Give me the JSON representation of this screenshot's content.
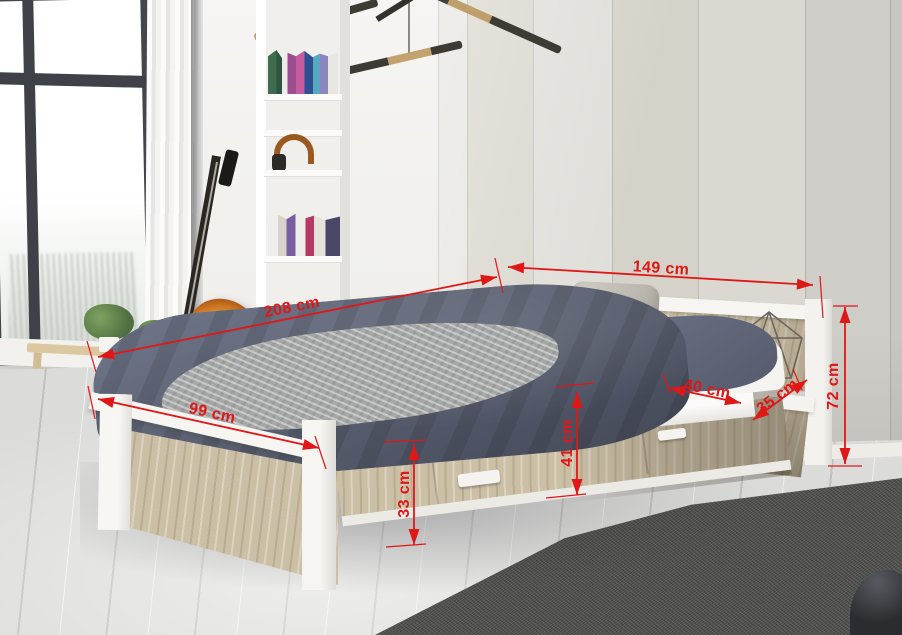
{
  "annotations": {
    "color": "#df1717",
    "unit": "cm",
    "labels": {
      "total_length": "208 cm",
      "headboard_width": "149 cm",
      "bed_width": "99 cm",
      "side_panel_height": "33 cm",
      "frame_height": "41 cm",
      "shelf_width": "40 cm",
      "shelf_depth": "35 cm",
      "headboard_height": "72 cm"
    }
  }
}
